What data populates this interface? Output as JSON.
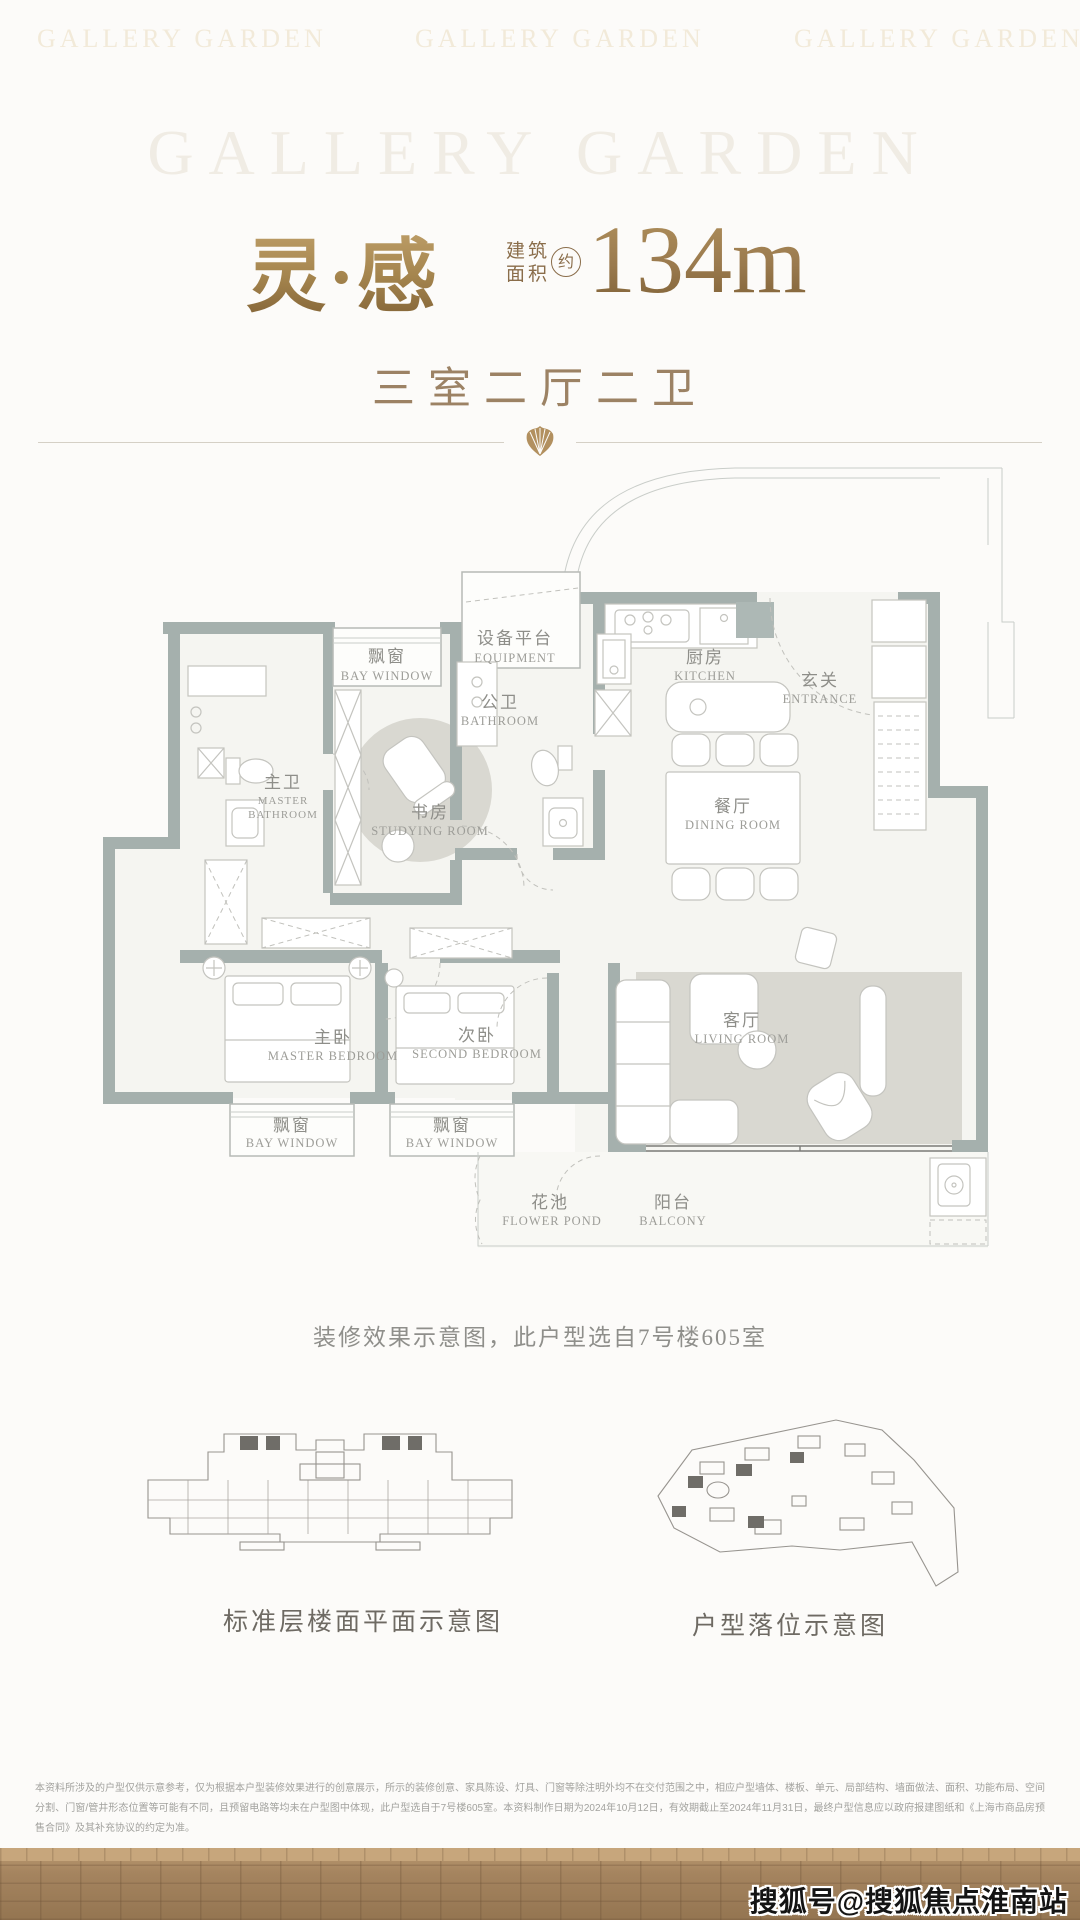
{
  "watermarks": {
    "top_brand": "GALLERY GARDEN",
    "bottom_right": "搜狐号@搜狐焦点淮南站"
  },
  "header": {
    "title": "灵·感",
    "area_label_line1": "建筑",
    "area_label_line2": "面积",
    "area_approx_badge": "约",
    "area_value": "134m",
    "area_unit_sup": "2",
    "layout_summary": "三室二厅二卫"
  },
  "floorplan": {
    "caption": "装修效果示意图，此户型选自7号楼605室",
    "rooms": {
      "bay_window_top": {
        "zh": "飘窗",
        "en": "BAY WINDOW"
      },
      "equipment": {
        "zh": "设备平台",
        "en": "EQUIPMENT"
      },
      "kitchen": {
        "zh": "厨房",
        "en": "KITCHEN"
      },
      "entrance": {
        "zh": "玄关",
        "en": "ENTRANCE"
      },
      "bathroom": {
        "zh": "公卫",
        "en": "BATHROOM"
      },
      "master_bathroom": {
        "zh": "主卫",
        "en1": "MASTER",
        "en2": "BATHROOM"
      },
      "studying_room": {
        "zh": "书房",
        "en": "STUDYING ROOM"
      },
      "dining_room": {
        "zh": "餐厅",
        "en": "DINING ROOM"
      },
      "master_bedroom": {
        "zh": "主卧",
        "en": "MASTER BEDROOM"
      },
      "second_bedroom": {
        "zh": "次卧",
        "en": "SECOND BEDROOM"
      },
      "living_room": {
        "zh": "客厅",
        "en": "LIVING ROOM"
      },
      "bay_window_left": {
        "zh": "飘窗",
        "en": "BAY WINDOW"
      },
      "bay_window_mid": {
        "zh": "飘窗",
        "en": "BAY WINDOW"
      },
      "flower_pond": {
        "zh": "花池",
        "en": "FLOWER POND"
      },
      "balcony": {
        "zh": "阳台",
        "en": "BALCONY"
      }
    }
  },
  "diagrams": {
    "left_caption": "标准层楼面平面示意图",
    "right_caption": "户型落位示意图"
  },
  "footer": {
    "disclaimer": "本资料所涉及的户型仅供示意参考，仅为根据本户型装修效果进行的创意展示，所示的装修创意、家具陈设、灯具、门窗等除注明外均不在交付范围之中，相应户型墙体、楼板、单元、局部结构、墙面做法、面积、功能布局、空间分割、门窗/管井形态位置等可能有不同，且预留电路等均未在户型图中体现，此户型选自于7号楼605室。本资料制作日期为2024年10月12日，有效期截止至2024年11月31日，最终户型信息应以政府报建图纸和《上海市商品房预售合同》及其补充协议的约定为准。",
    "brand_repeat": [
      "GALLERY GARDEN",
      "GALLERY GARDEN",
      "GALLERY GARDEN"
    ]
  },
  "colors": {
    "gold": "#a5854e",
    "wall_gray_green": "#a5b0ad",
    "brick_brown": "#a5845f",
    "label_gray": "#9d9d98"
  }
}
